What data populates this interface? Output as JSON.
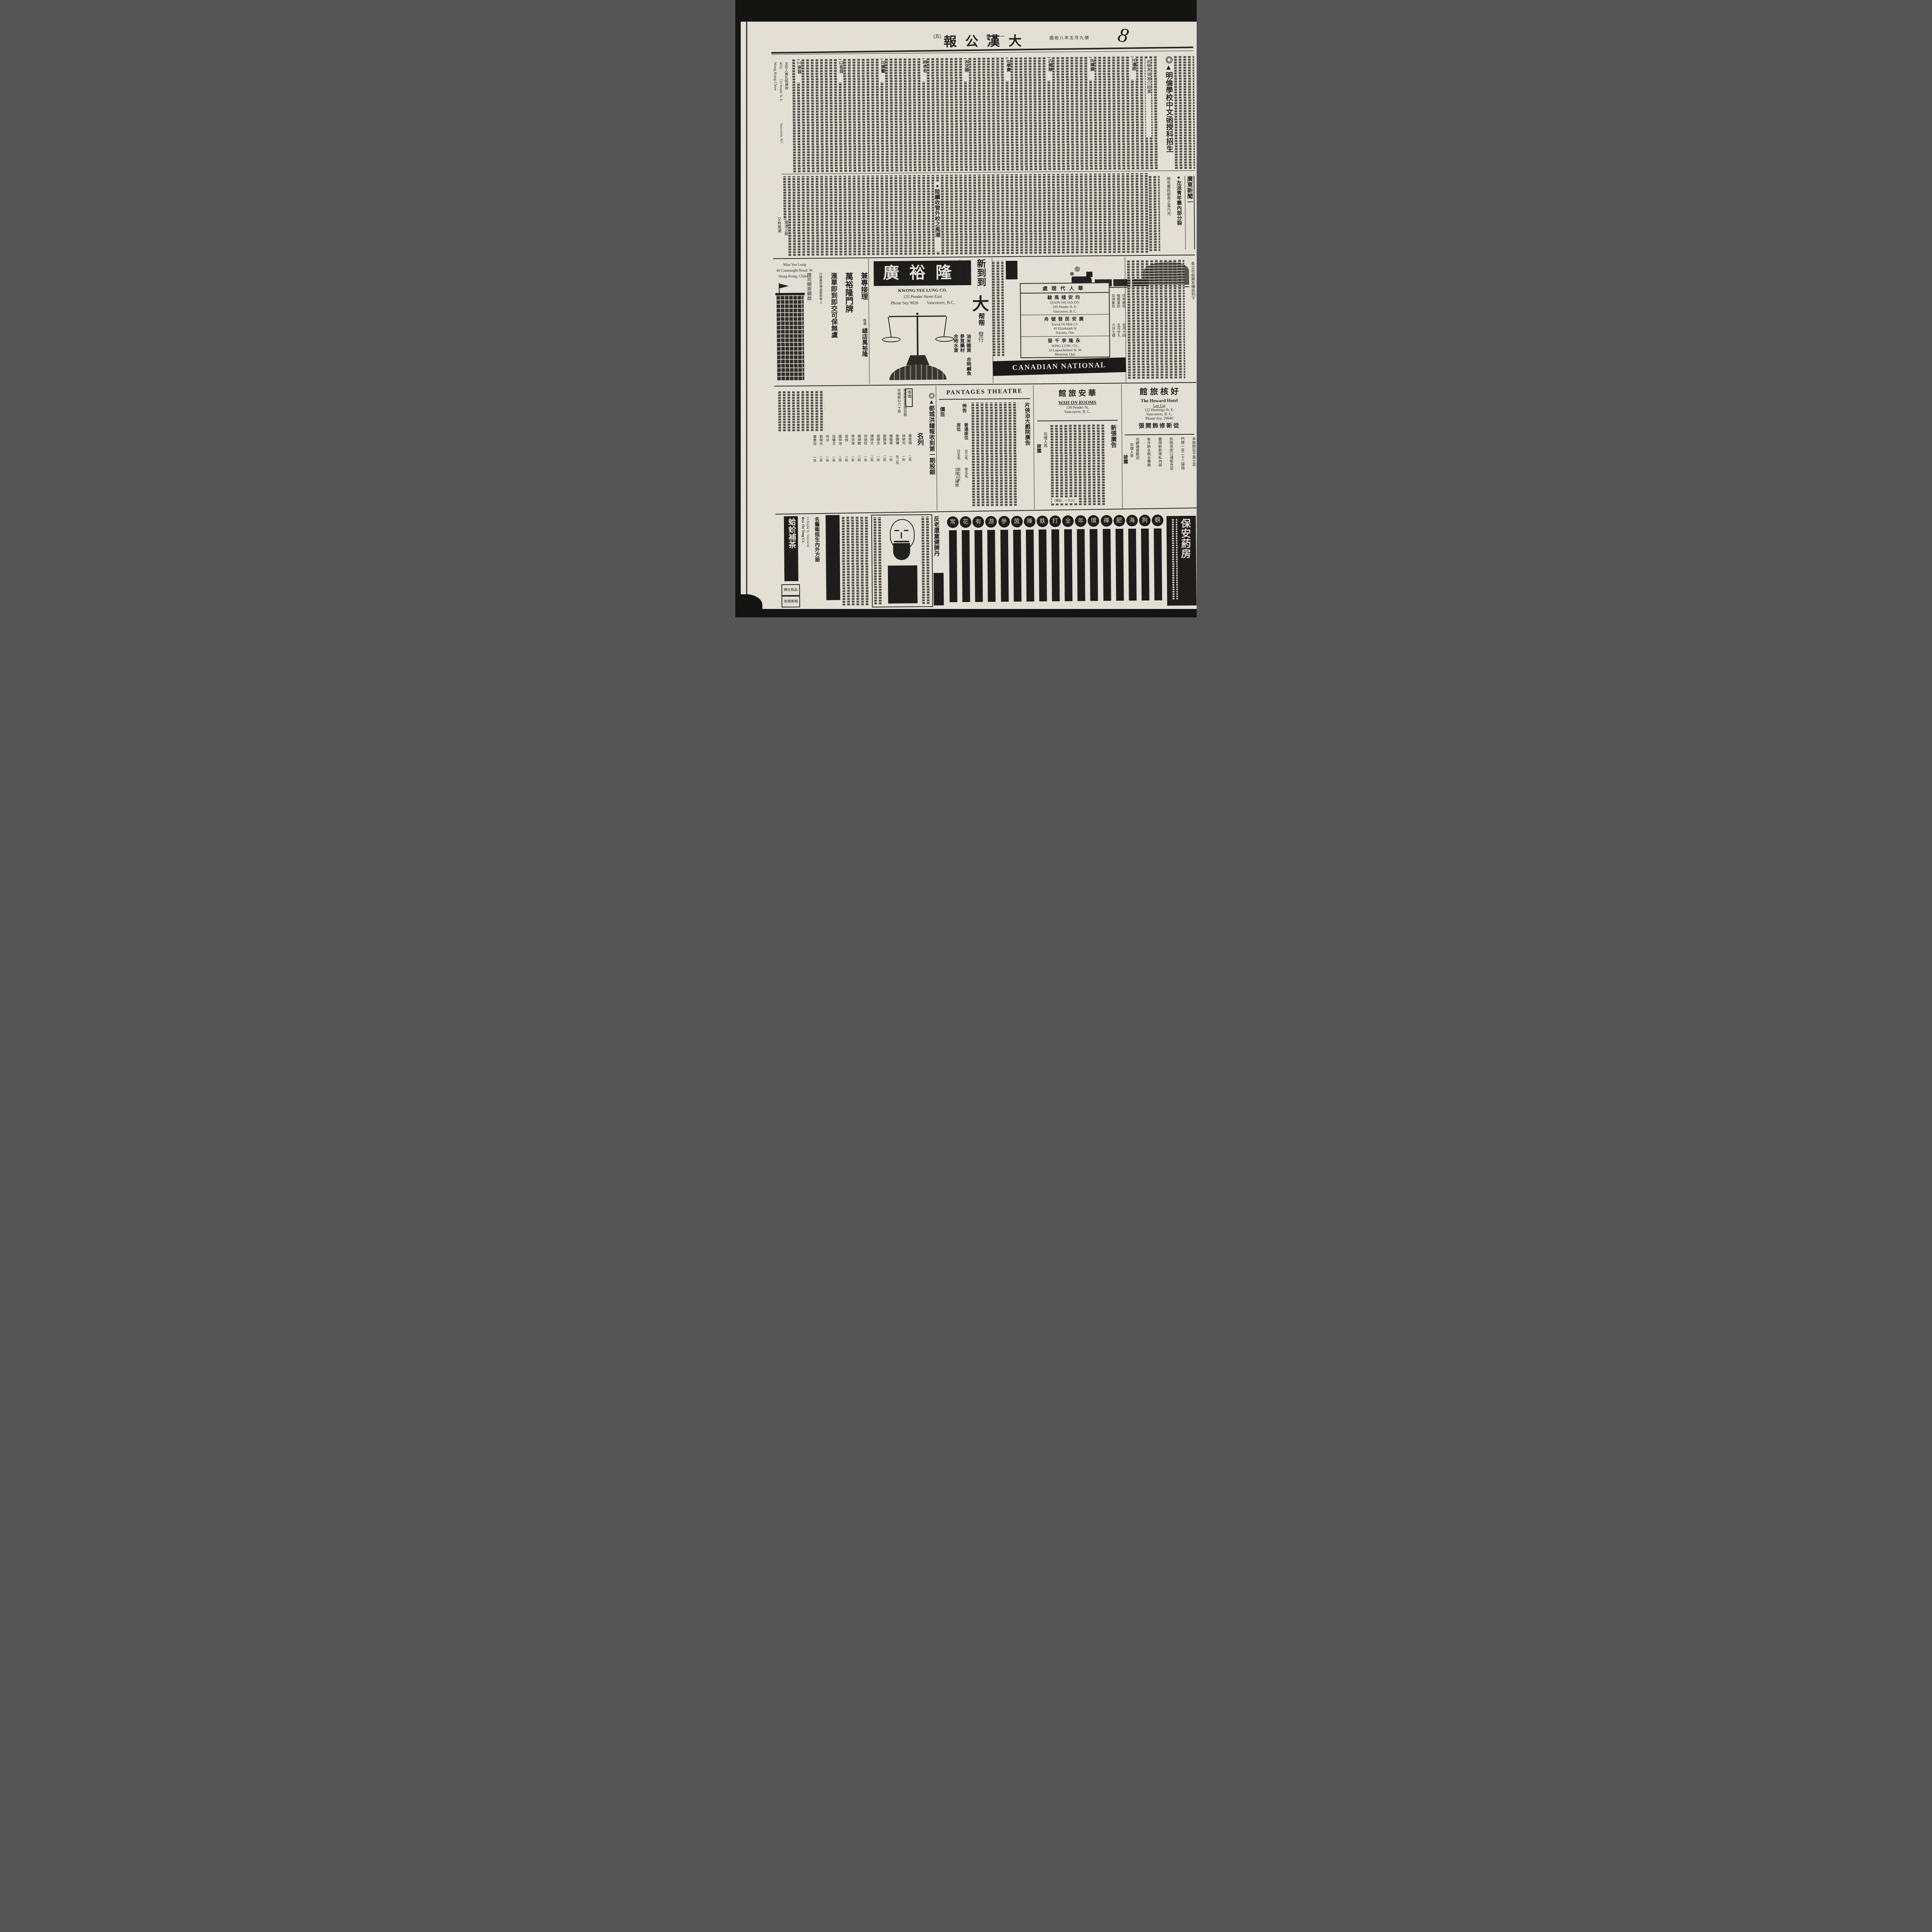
{
  "page": {
    "number_label": "(五)",
    "weekday": "星期一",
    "masthead": "大漢公報",
    "masthead_display": "報公漢大",
    "date_line": "國拾八年五月九號",
    "handwritten_mark": "8"
  },
  "school_ad": {
    "headline": "◎▲明倫學校中文函授科招生",
    "intro_column": "前學界領袖介紹書",
    "section_markers": [
      "㈩通訊",
      "㈨擇課",
      "㈧開辦",
      "㈦學費",
      "㈤交際",
      "㈣命名",
      "㈢課藝",
      "㈡名目",
      "㈠宗旨"
    ],
    "contact": {
      "name_en": "Wong Kong Chow",
      "phone": "4032.",
      "addr1": "722 Pender St. E.",
      "addr2": "Vancouver, B.C.",
      "signature": "主任人黃孔昭謹啟"
    },
    "tail1": "又有風潮",
    "tail2": "雲湧之勢"
  },
  "news": {
    "rail_header": "廣東新聞一",
    "headline_split": "●左派青年團內部分裂",
    "headline_sub": "現充農民部長之易乃光",
    "headline_schools": "●陸續收管外校之風潮"
  },
  "man_yee_lung": {
    "en1": "Man Yee Lung",
    "en2": "40 Connaught Road. W.",
    "en3": "Hong Kong, China",
    "service": "兼專接理",
    "branch_small": "香港",
    "branch": "總店萬裕隆",
    "big1": "萬裕隆門牌",
    "big2": "滙單即到即交可保無虞",
    "note": "行情異即便函索即奉上",
    "signature": "理司關崇顯啟"
  },
  "kwong_yee_lung": {
    "banner_display": "廣裕隆",
    "en1": "KWONG YEE LUNG CO.",
    "en2": "135 Pender Street East",
    "en3": "Phone Sey 9026        Vancouver, B.C.",
    "big_new": "新到到",
    "big_da": "大",
    "helpers": "帮帮",
    "goods": [
      "油米雜貨",
      "參茸藥材",
      "合時水貨",
      "合時鹹魚"
    ],
    "col1": "本玻璃圍合",
    "col2": "時蔬菜常有",
    "distrib": "發行"
  },
  "cnr": {
    "agents_header_display": "處理代人華",
    "agents": [
      {
        "cn": "駿馬棧安均",
        "en1": "QUON ON JAN CO.",
        "en2": "295 Pender St. E.",
        "en3": "Vancouver, B. C."
      },
      {
        "cn": "舟號發民安廣",
        "en1": "Kwon On Man Co.",
        "en2": "45 Elizebeath St",
        "en3": "Toronto, Ont."
      },
      {
        "cn": "發千李隆永",
        "en1": "WING LUNG CO.,",
        "en2": "33 Lagauchetiere St. W.",
        "en3": "Montreal, Que."
      }
    ],
    "ships": [
      {
        "name": "日本皇后",
        "date": "五月十四"
      },
      {
        "name": "俄國皇后",
        "date": "五月廿九"
      },
      {
        "name": "亞洲皇后",
        "date": "六月七號"
      }
    ],
    "fares_label": "各公司船期及價目列下",
    "banner": "CANADIAN NATIONAL RAILWAYS"
  },
  "shares": {
    "headline": "◎▲都城洪鐘報收到第一期股銀",
    "headline2": "名列",
    "group_header": "本埠",
    "lead_entries": [
      "域成政公司四百股",
      "坎城政公六十股"
    ],
    "entries": [
      {
        "n": "黃俊傑",
        "s": "二股"
      },
      {
        "n": "林榮光",
        "s": "一股"
      },
      {
        "n": "麥錦鏞",
        "s": "各二股"
      },
      {
        "n": "陳蔭南",
        "s": "一股"
      },
      {
        "n": "劉興淮",
        "s": "二股"
      },
      {
        "n": "周棣生",
        "s": "一股"
      },
      {
        "n": "譚焯文",
        "s": "二股"
      },
      {
        "n": "司徒旺",
        "s": "一股"
      },
      {
        "n": "關焯勳",
        "s": "二股"
      },
      {
        "n": "李洪淮",
        "s": "一股"
      },
      {
        "n": "梁桂",
        "s": "一股"
      },
      {
        "n": "雷仲池",
        "s": "二股"
      },
      {
        "n": "伍耀文",
        "s": "一股"
      },
      {
        "n": "何法",
        "s": "一股"
      },
      {
        "n": "劉榮光",
        "s": "二股"
      },
      {
        "n": "葉惠伯",
        "s": "一股"
      }
    ]
  },
  "pantages": {
    "title": "PANTAGES  THEATRE",
    "notice": "佈告",
    "side_headline": "片俠治大戲院廣告",
    "price_header": "價目",
    "prices": [
      {
        "seat": "普通座位",
        "day": "日三毛",
        "night": "夜五毛"
      },
      {
        "seat": "房位",
        "day": "日五毛",
        "night": "夜七毛半"
      }
    ],
    "signature": "司理人謹啟"
  },
  "wah_on": {
    "cn_display": "館 旅 安 華",
    "en1": "WAH ON ROOMS",
    "en2": "139 Pender St,",
    "en3": "Vancouver,  B. C.",
    "new_ad": "新張廣告",
    "phone_note": "（電話…一九九）",
    "signature1": "司理人馬",
    "signature2": "披露"
  },
  "howard": {
    "cn_display": "館 旅 核 好",
    "en1": "The  Howard  Hotel",
    "en2": "Lee Lip",
    "en3": "122 Hastings St. E.",
    "en4": "Vancouver,  B. C.",
    "en5": "Phone Sey. 29640",
    "reopen_display": "張開飾修新從",
    "body": [
      "本旅館在于喜士定",
      "門牌一百二十二號特",
      "別改良房口通氣充足",
      "盡用新款傢私內設",
      "有冷熱水俱全備胞",
      "光顧諸君歡迎"
    ],
    "signature1": "司理人李",
    "signature2": "披露"
  },
  "bottom": {
    "tea_display": "蛤蚧補茶",
    "sub_box1": "親化桂品",
    "sub_box2": "各頭香烟",
    "bow_on_en1": "Bow On Tong Co.",
    "bow_on_en2": "13 Pender St. Vancouver",
    "doctor": "名醫衛挺生內外方脈",
    "tonic": "反老還童健脾丹",
    "pharmacy_display": "保安葯房",
    "badges": [
      "覩",
      "狗",
      "海",
      "肥",
      "禪",
      "環",
      "年",
      "全",
      "打",
      "鉄",
      "陳",
      "茵",
      "參",
      "游",
      "有",
      "花",
      "常"
    ]
  }
}
